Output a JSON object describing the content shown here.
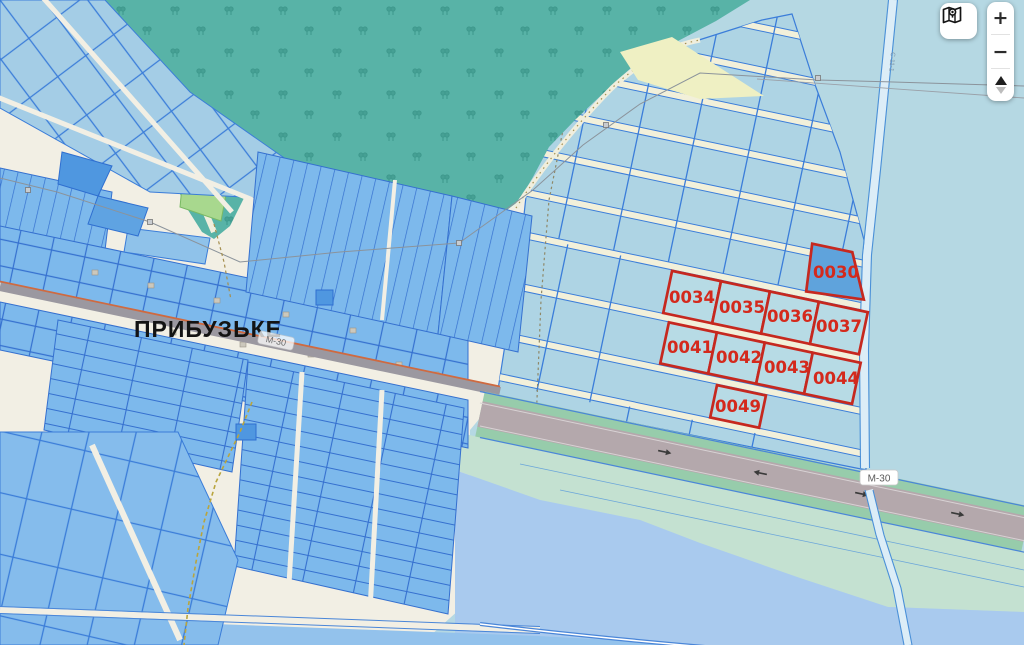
{
  "map": {
    "village_label": "ПРИБУЗЬКЕ",
    "highway_label": "М-30",
    "highway_label_secondary": "М-30",
    "canal_label": "С-11-1",
    "parcels": {
      "highlight_color": "#c6281f",
      "items": [
        {
          "id": "0030"
        },
        {
          "id": "0034"
        },
        {
          "id": "0035"
        },
        {
          "id": "0036"
        },
        {
          "id": "0037"
        },
        {
          "id": "0041"
        },
        {
          "id": "0042"
        },
        {
          "id": "0043"
        },
        {
          "id": "0044"
        },
        {
          "id": "0049"
        }
      ]
    },
    "colors": {
      "water_background": "#b5d8e3",
      "village_ground": "#f2efe4",
      "forest": "#58b3a7",
      "parcel_blue": "#7db9ec",
      "parcel_border": "#3a7cd8",
      "highlight_red": "#c6281f",
      "highway_asphalt": "#b4a8ac",
      "highway_margin": "#97ccab"
    }
  },
  "controls": {
    "zoom_in_label": "+",
    "zoom_out_label": "−"
  }
}
